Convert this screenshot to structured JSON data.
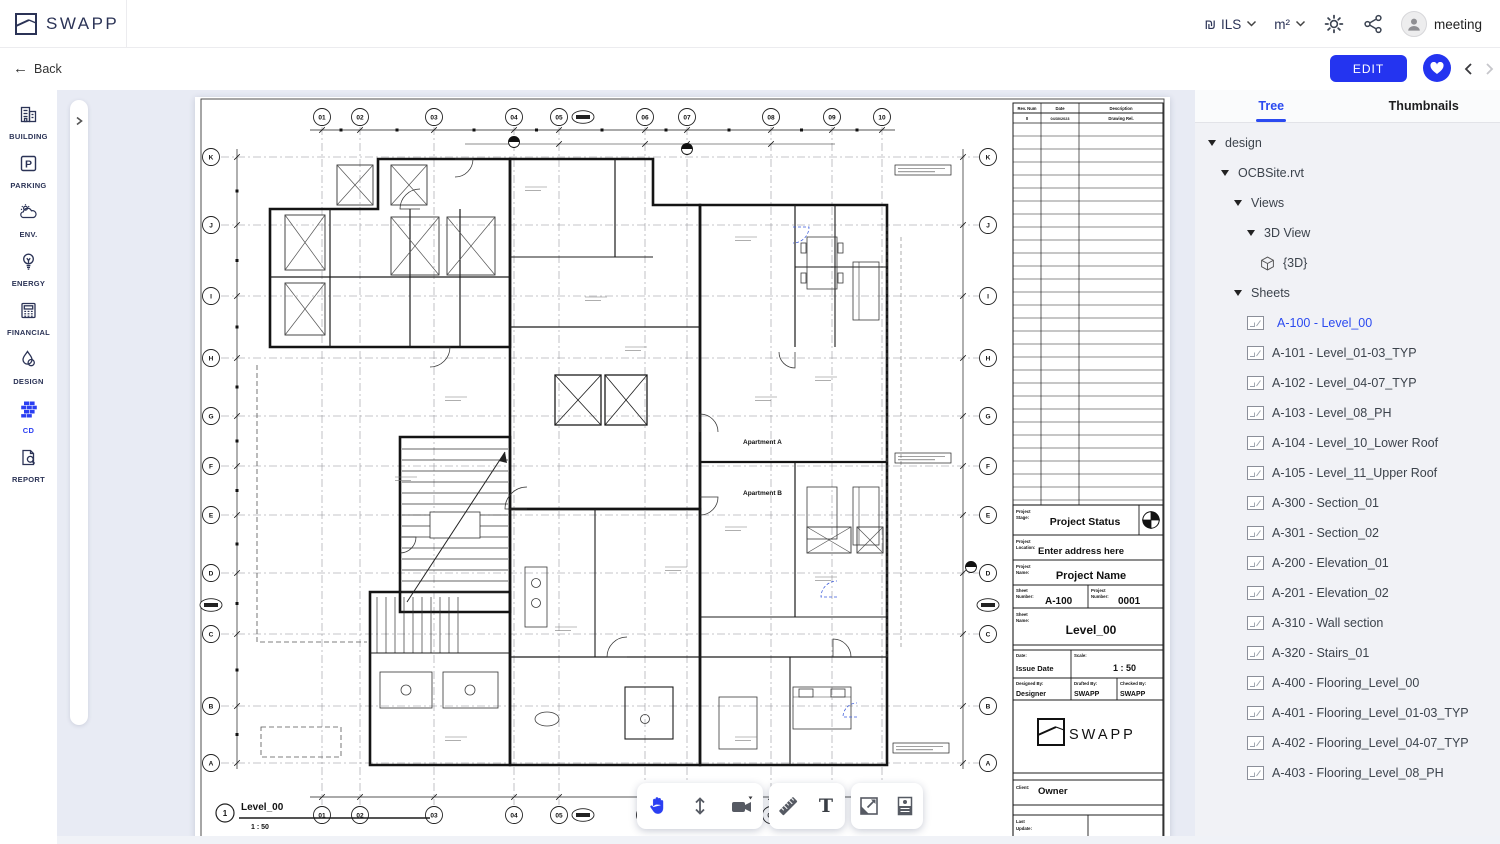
{
  "header": {
    "brand": "SWAPP",
    "currency_symbol": "₪",
    "currency_label": "ILS",
    "unit_label": "m²",
    "user_name": "meeting"
  },
  "subheader": {
    "back_label": "Back",
    "edit_label": "EDIT"
  },
  "sidebar": {
    "active": "CD",
    "items": [
      {
        "label": "BUILDING",
        "icon": "building-icon"
      },
      {
        "label": "PARKING",
        "icon": "parking-icon"
      },
      {
        "label": "ENV.",
        "icon": "environment-icon"
      },
      {
        "label": "ENERGY",
        "icon": "energy-icon"
      },
      {
        "label": "FINANCIAL",
        "icon": "financial-icon"
      },
      {
        "label": "DESIGN",
        "icon": "design-icon"
      },
      {
        "label": "CD",
        "icon": "cd-bricks-icon"
      },
      {
        "label": "REPORT",
        "icon": "report-icon"
      }
    ]
  },
  "panel": {
    "tabs": [
      "Tree",
      "Thumbnails"
    ],
    "active_tab": "Tree",
    "tree": [
      {
        "label": "design",
        "level": 0,
        "caret": true
      },
      {
        "label": "OCBSite.rvt",
        "level": 1,
        "caret": true
      },
      {
        "label": "Views",
        "level": 2,
        "caret": true
      },
      {
        "label": "3D View",
        "level": 3,
        "caret": true
      },
      {
        "label": "{3D}",
        "level": 4,
        "icon": "cube"
      },
      {
        "label": "Sheets",
        "level": 2,
        "caret": true
      },
      {
        "label": "A-100 - Level_00",
        "level": 3,
        "icon": "sheet",
        "selected": true
      },
      {
        "label": "A-101 - Level_01-03_TYP",
        "level": 3,
        "icon": "sheet"
      },
      {
        "label": "A-102 - Level_04-07_TYP",
        "level": 3,
        "icon": "sheet"
      },
      {
        "label": "A-103 - Level_08_PH",
        "level": 3,
        "icon": "sheet"
      },
      {
        "label": "A-104 - Level_10_Lower Roof",
        "level": 3,
        "icon": "sheet"
      },
      {
        "label": "A-105 - Level_11_Upper Roof",
        "level": 3,
        "icon": "sheet"
      },
      {
        "label": "A-300 - Section_01",
        "level": 3,
        "icon": "sheet"
      },
      {
        "label": "A-301 - Section_02",
        "level": 3,
        "icon": "sheet"
      },
      {
        "label": "A-200 - Elevation_01",
        "level": 3,
        "icon": "sheet"
      },
      {
        "label": "A-201 - Elevation_02",
        "level": 3,
        "icon": "sheet"
      },
      {
        "label": "A-310 - Wall section",
        "level": 3,
        "icon": "sheet"
      },
      {
        "label": "A-320 - Stairs_01",
        "level": 3,
        "icon": "sheet"
      },
      {
        "label": "A-400 - Flooring_Level_00",
        "level": 3,
        "icon": "sheet"
      },
      {
        "label": "A-401 - Flooring_Level_01-03_TYP",
        "level": 3,
        "icon": "sheet"
      },
      {
        "label": "A-402 - Flooring_Level_04-07_TYP",
        "level": 3,
        "icon": "sheet"
      },
      {
        "label": "A-403 - Flooring_Level_08_PH",
        "level": 3,
        "icon": "sheet"
      }
    ]
  },
  "sheet": {
    "grid_columns": [
      "01",
      "02",
      "03",
      "04",
      "05",
      "06",
      "07",
      "08",
      "09",
      "10"
    ],
    "grid_rows": [
      "K",
      "J",
      "I",
      "H",
      "G",
      "F",
      "E",
      "D",
      "C",
      "B",
      "A"
    ],
    "apartment_labels": [
      "Apartment A",
      "Apartment B"
    ],
    "view": {
      "number": "1",
      "title": "Level_00",
      "scale": "1 : 50"
    },
    "revision_table": {
      "headers": [
        "Rev. Num",
        "Date",
        "Description"
      ],
      "rows": [
        [
          "0",
          "04/30/2023",
          "Drawing Rel."
        ]
      ]
    },
    "title_block": {
      "stage_label": "Project Stage:",
      "stage_value": "Project Status",
      "location_label": "Project Location:",
      "location_value": "Enter address here",
      "name_label": "Project Name:",
      "name_value": "Project Name",
      "sheet_number_label": "Sheet Number:",
      "sheet_number_value": "A-100",
      "project_number_label": "Project Number:",
      "project_number_value": "0001",
      "sheet_name_label": "Sheet Name:",
      "sheet_name_value": "Level_00",
      "date_label": "Date:",
      "date_value": "Issue Date",
      "scale_label": "Scale:",
      "scale_value": "1 : 50",
      "designed_label": "Designed By:",
      "designed_value": "Designer",
      "drafted_label": "Drafted By:",
      "drafted_value": "SWAPP",
      "checked_label": "Checked By:",
      "checked_value": "SWAPP",
      "brand": "SWAPP",
      "client_label": "Client:",
      "client_value": "Owner",
      "last_update_label": "Last Update:"
    }
  },
  "toolbar": {
    "tools": [
      "pan",
      "height-measure",
      "camera",
      "ruler",
      "text",
      "image-export",
      "sheet-info"
    ]
  },
  "colors": {
    "accent": "#2434f0",
    "link": "#2b4af0",
    "navy": "#2b3356",
    "canvas": "#e8ebf4"
  }
}
